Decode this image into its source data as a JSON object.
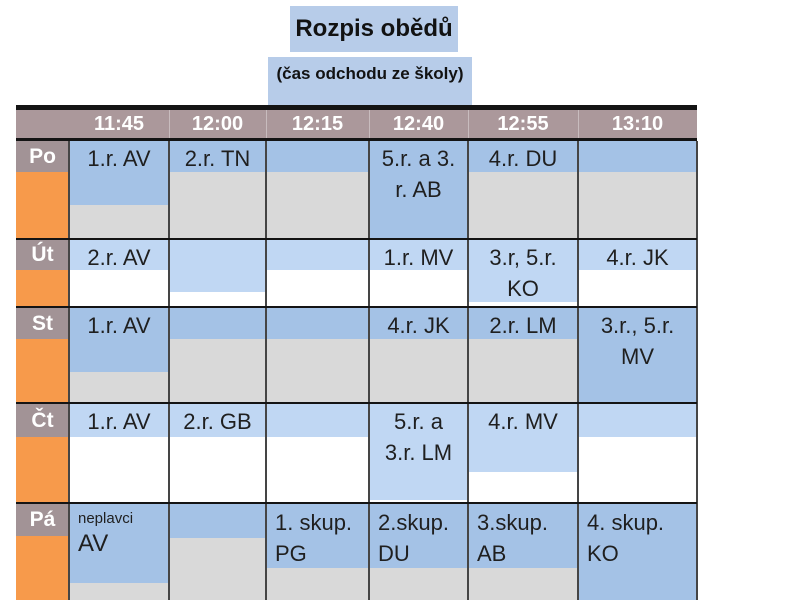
{
  "title": {
    "text": "Rozpis obědů"
  },
  "subtitle": {
    "text": "(čas odchodu ze školy)"
  },
  "colors": {
    "title_bg": "#b7cce9",
    "header_bg": "#ab989b",
    "label_bg": "#a29396",
    "orange": "#f79a4b",
    "blue_dark": "#a4c2e6",
    "blue_light": "#c0d7f3",
    "gray": "#d9d9d9",
    "white": "#ffffff",
    "col_border": "#454545",
    "row_border": "#141414",
    "text": "#1f1f1f"
  },
  "table": {
    "header": [
      "11:45",
      "12:00",
      "12:15",
      "12:40",
      "12:55",
      "13:10"
    ],
    "rows": [
      {
        "day": "Po",
        "top": 141,
        "height": 97,
        "label_h": 31,
        "blue": "dark",
        "secondary": "gray",
        "align": "center",
        "cells": [
          {
            "lines": [
              "1.r. AV"
            ],
            "blue_h": 64
          },
          {
            "lines": [
              "2.r. TN"
            ],
            "blue_h": 31
          },
          {
            "lines": [],
            "blue_h": 31
          },
          {
            "lines": [
              "5.r. a 3.",
              "r. AB"
            ],
            "blue_h": 97
          },
          {
            "lines": [
              "4.r. DU"
            ],
            "blue_h": 31
          },
          {
            "lines": [],
            "blue_h": 31
          }
        ]
      },
      {
        "day": "Út",
        "top": 240,
        "height": 66,
        "label_h": 30,
        "blue": "light",
        "secondary": "white",
        "align": "center",
        "cells": [
          {
            "lines": [
              "2.r. AV"
            ],
            "blue_h": 30
          },
          {
            "lines": [],
            "blue_h": 52
          },
          {
            "lines": [],
            "blue_h": 30
          },
          {
            "lines": [
              "1.r. MV"
            ],
            "blue_h": 30
          },
          {
            "lines": [
              "3.r, 5.r.",
              "KO"
            ],
            "blue_h": 62
          },
          {
            "lines": [
              "4.r. JK"
            ],
            "blue_h": 30
          }
        ]
      },
      {
        "day": "St",
        "top": 308,
        "height": 94,
        "label_h": 31,
        "blue": "dark",
        "secondary": "gray",
        "align": "center",
        "cells": [
          {
            "lines": [
              "1.r. AV"
            ],
            "blue_h": 64
          },
          {
            "lines": [],
            "blue_h": 31
          },
          {
            "lines": [],
            "blue_h": 31
          },
          {
            "lines": [
              "4.r. JK"
            ],
            "blue_h": 31
          },
          {
            "lines": [
              "2.r. LM"
            ],
            "blue_h": 31
          },
          {
            "lines": [
              "3.r., 5.r.",
              "MV"
            ],
            "blue_h": 94
          }
        ]
      },
      {
        "day": "Čt",
        "top": 404,
        "height": 98,
        "label_h": 33,
        "blue": "light",
        "secondary": "white",
        "align": "center",
        "cells": [
          {
            "lines": [
              "1.r. AV"
            ],
            "blue_h": 33
          },
          {
            "lines": [
              "2.r. GB"
            ],
            "blue_h": 33
          },
          {
            "lines": [],
            "blue_h": 33
          },
          {
            "lines": [
              "5.r. a",
              "3.r. LM"
            ],
            "blue_h": 96
          },
          {
            "lines": [
              "4.r. MV"
            ],
            "blue_h": 68
          },
          {
            "lines": [],
            "blue_h": 33
          }
        ]
      },
      {
        "day": "Pá",
        "top": 504,
        "height": 96,
        "label_h": 32,
        "blue": "dark",
        "secondary": "gray",
        "align": "left",
        "cells": [
          {
            "lines": [
              "neplavci",
              "AV"
            ],
            "blue_h": 79,
            "small_first": true
          },
          {
            "lines": [],
            "blue_h": 34
          },
          {
            "lines": [
              "1. skup.",
              "PG"
            ],
            "blue_h": 64
          },
          {
            "lines": [
              "2.skup.",
              "DU"
            ],
            "blue_h": 64
          },
          {
            "lines": [
              "3.skup.",
              "AB"
            ],
            "blue_h": 64
          },
          {
            "lines": [
              "4. skup.",
              "KO"
            ],
            "blue_h": 96
          }
        ]
      }
    ]
  }
}
